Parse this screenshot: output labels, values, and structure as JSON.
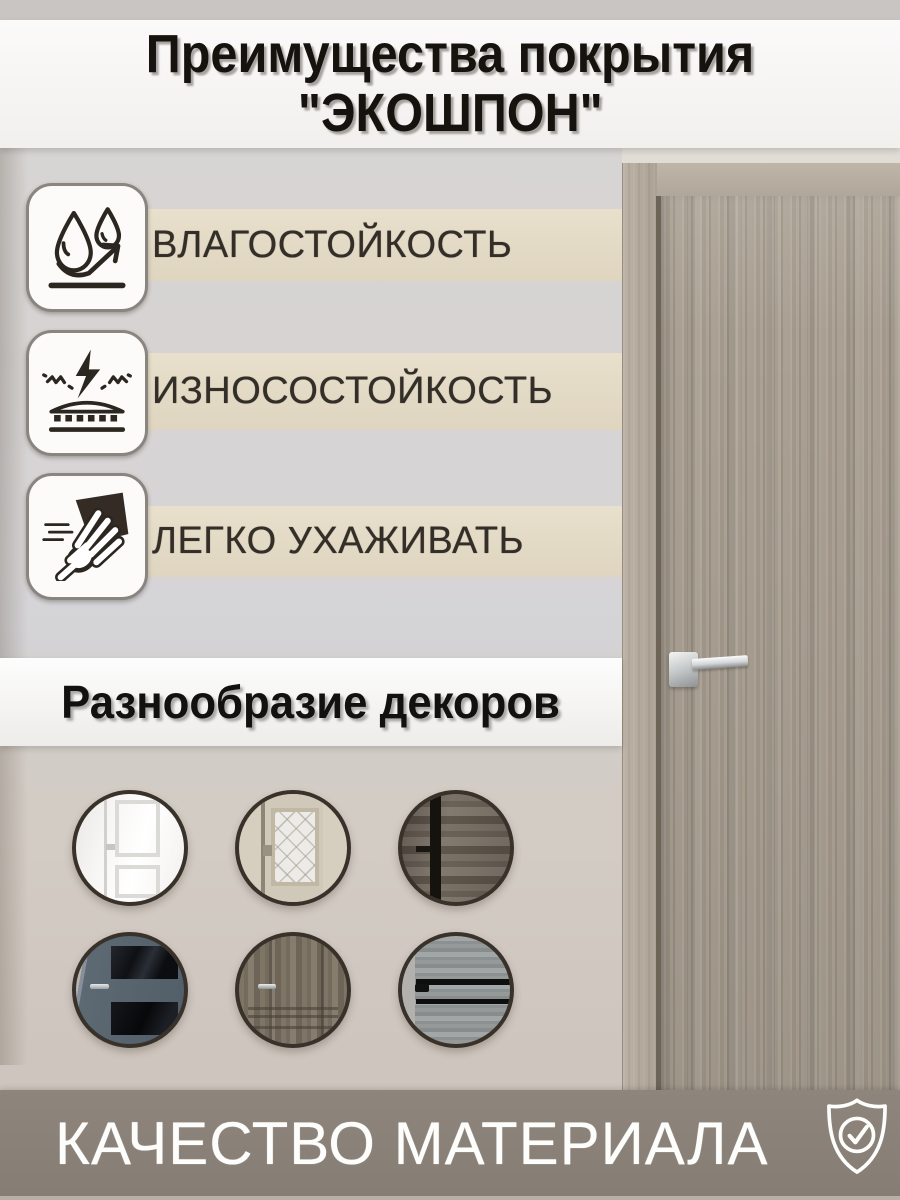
{
  "title": {
    "line1": "Преимущества покрытия",
    "line2": "\"ЭКОШПОН\""
  },
  "features": [
    {
      "icon": "water-drops-icon",
      "label": "ВЛАГОСТОЙКОСТЬ"
    },
    {
      "icon": "impact-surface-icon",
      "label": "ИЗНОСОСТОЙКОСТЬ"
    },
    {
      "icon": "wiping-hand-icon",
      "label": "ЛЕГКО УХАЖИВАТЬ"
    }
  ],
  "decors": {
    "title": "Разнообразие декоров",
    "items": [
      {
        "name": "white-classic-panel-door"
      },
      {
        "name": "ivory-door-patterned-glass"
      },
      {
        "name": "rustic-dark-wood-black-edge"
      },
      {
        "name": "blue-gray-door-dark-glass"
      },
      {
        "name": "gray-brown-panel-door"
      },
      {
        "name": "light-gray-wood-black-inserts"
      }
    ]
  },
  "footer": {
    "label": "КАЧЕСТВО МАТЕРИАЛА",
    "icon": "shield-check-icon"
  },
  "colors": {
    "accent_beige": "#e6ddc7",
    "banner_white": "#f8f6f4",
    "footer_taupe": "#8a8078",
    "text_dark": "#332e28",
    "door_wood": "#a89e91",
    "circle_ring": "#39322b"
  }
}
